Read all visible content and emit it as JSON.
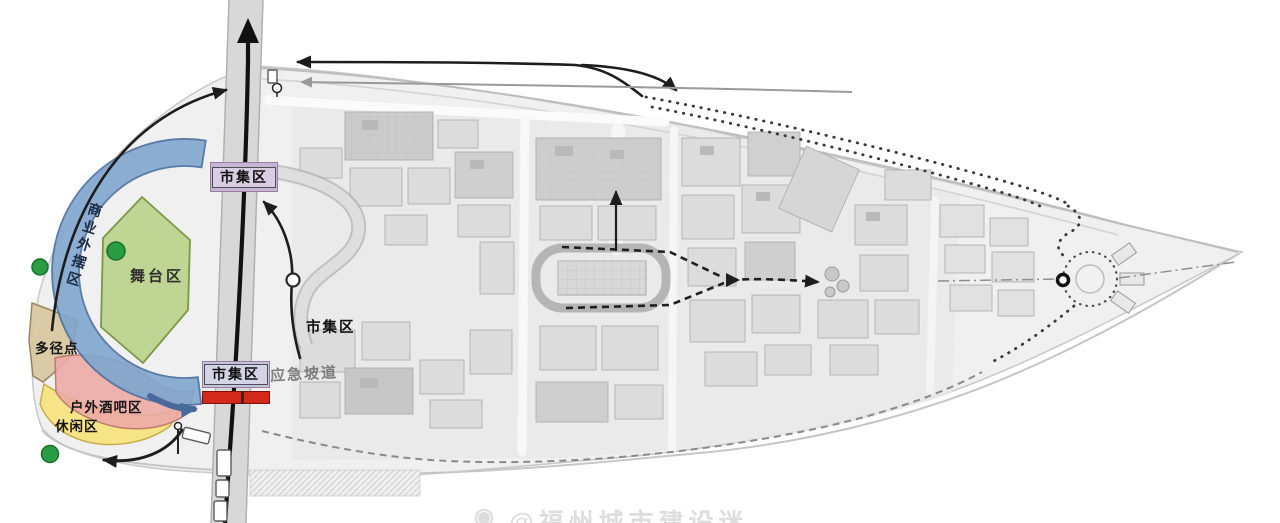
{
  "plan_title": "商业街区活动分区与动线平面图",
  "legend_zones": {
    "commercial": {
      "label": "商业外摆区",
      "color": "#7fa6ce"
    },
    "stage": {
      "label": "舞台区",
      "color": "#bcd48f"
    },
    "multipath": {
      "label": "多径点",
      "color": "#d9c9a2"
    },
    "bar": {
      "label": "户外酒吧区",
      "color": "#eda9a6"
    },
    "leisure": {
      "label": "休闲区",
      "color": "#f8e47f"
    }
  },
  "labels": {
    "market_top": "市集区",
    "market_mid": "市集区",
    "market_bottom": "市集区",
    "emergency_ramp": "应急坡道"
  },
  "colors": {
    "market_box_bg": "#c7b4d7",
    "market_red_bar": "#d2291b",
    "event_dot": "#2a9c43",
    "arc_border": "#4a6fa0",
    "arrow_black": "#1d1d1d"
  },
  "watermark": {
    "logo": "◉",
    "text": "@福州城市建设迷"
  }
}
